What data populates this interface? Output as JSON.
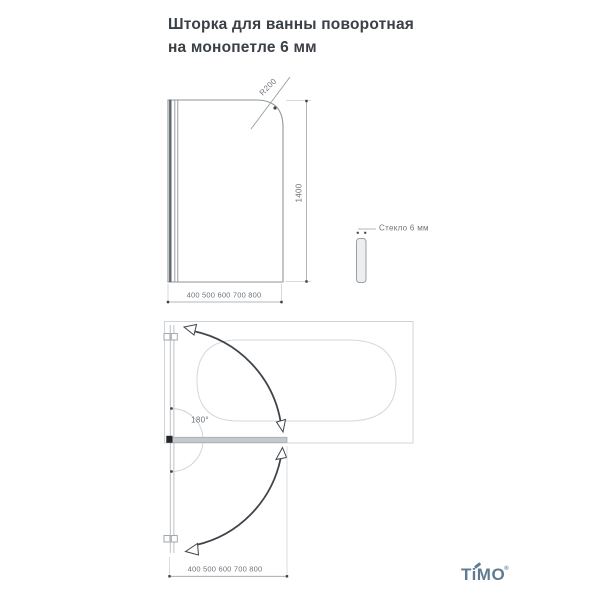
{
  "title": {
    "line1": "Шторка для ванны поворотная",
    "line2": "на монопетле 6 мм"
  },
  "front_view": {
    "radius_label": "R200",
    "height_label": "1400",
    "width_label": "400 500 600 700 800"
  },
  "side_view": {
    "glass_label": "Стекло 6 мм"
  },
  "top_view": {
    "rotation_label": "180°",
    "width_label": "400 500 600 700 800"
  },
  "brand": {
    "name": "TiMO",
    "registered": "®"
  },
  "colors": {
    "title_text": "#3b4047",
    "dimension_text": "#6e747a",
    "drawing_line": "#8f969b",
    "light_line": "#d0d4d7",
    "swing_arrow": "#3f444a",
    "brand_blue": "#5e7b91"
  }
}
